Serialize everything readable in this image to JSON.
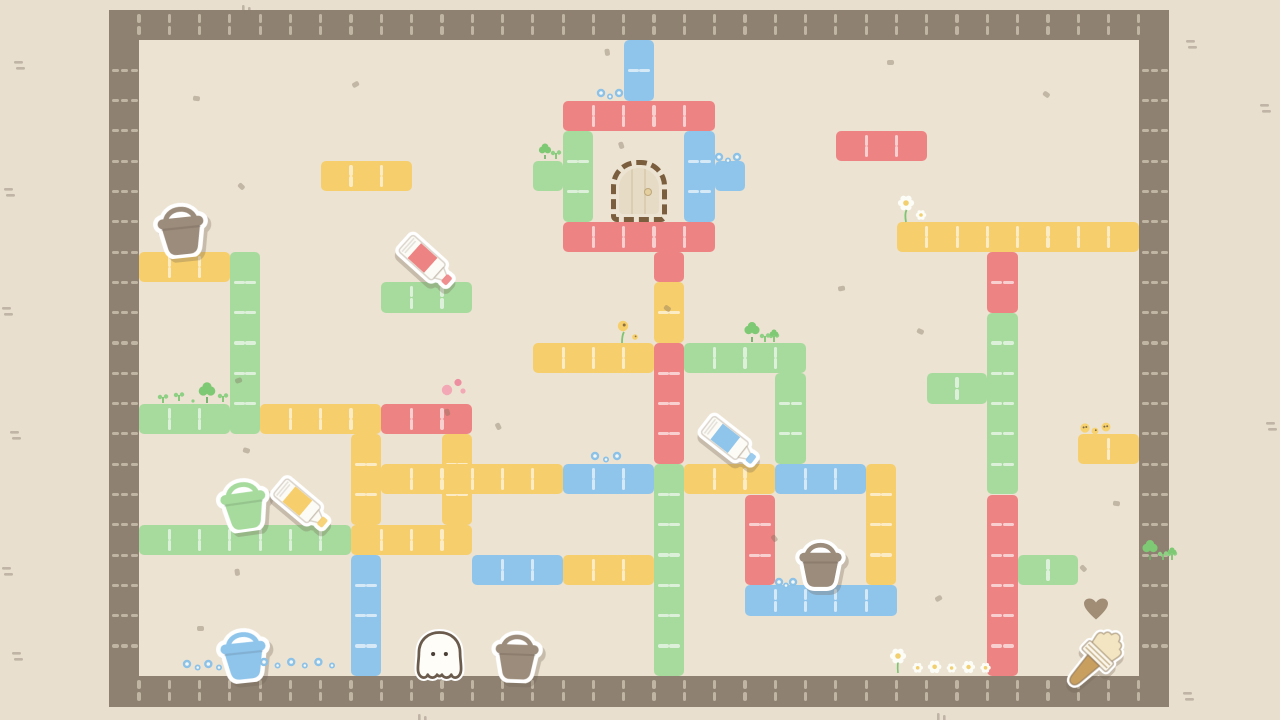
{
  "scene": {
    "width": 1280,
    "height": 720,
    "bg_outer": "#e8dfcf",
    "bg_inner": "#ece3d2",
    "wall_color": "#8e8172",
    "wall_dash": "rgba(223,213,192,0.62)",
    "block_dash": "rgba(255,255,255,0.62)",
    "shadow": "rgba(112,98,82,0.30)",
    "outline": "#6a5b4c"
  },
  "grid": {
    "origin_x": 139,
    "origin_y": 40,
    "tile": 30.3,
    "cols": 33,
    "rows": 21
  },
  "palette": {
    "red": "#ee8383",
    "yellow": "#f6ce6b",
    "green": "#a7db9e",
    "blue": "#90c5eb"
  },
  "blocks": [
    {
      "color": "blue",
      "c": 16,
      "r": 0,
      "w": 1,
      "h": 2
    },
    {
      "color": "red",
      "c": 14,
      "r": 2,
      "w": 5,
      "h": 1
    },
    {
      "color": "green",
      "c": 14,
      "r": 3,
      "w": 1,
      "h": 3
    },
    {
      "color": "green",
      "c": 13,
      "r": 4,
      "w": 1,
      "h": 1
    },
    {
      "color": "blue",
      "c": 18,
      "r": 3,
      "w": 1,
      "h": 3
    },
    {
      "color": "blue",
      "c": 19,
      "r": 4,
      "w": 1,
      "h": 1
    },
    {
      "color": "red",
      "c": 14,
      "r": 6,
      "w": 5,
      "h": 1
    },
    {
      "color": "red",
      "c": 17,
      "r": 7,
      "w": 1,
      "h": 1
    },
    {
      "color": "yellow",
      "c": 17,
      "r": 8,
      "w": 1,
      "h": 2
    },
    {
      "color": "red",
      "c": 17,
      "r": 10,
      "w": 1,
      "h": 4
    },
    {
      "color": "green",
      "c": 17,
      "r": 14,
      "w": 1,
      "h": 7
    },
    {
      "color": "yellow",
      "c": 13,
      "r": 10,
      "w": 4,
      "h": 1
    },
    {
      "color": "green",
      "c": 18,
      "r": 10,
      "w": 4,
      "h": 1
    },
    {
      "color": "green",
      "c": 21,
      "r": 11,
      "w": 1,
      "h": 3
    },
    {
      "color": "red",
      "c": 23,
      "r": 3,
      "w": 3,
      "h": 1
    },
    {
      "color": "yellow",
      "c": 25,
      "r": 6,
      "w": 8,
      "h": 1
    },
    {
      "color": "red",
      "c": 28,
      "r": 7,
      "w": 1,
      "h": 2
    },
    {
      "color": "green",
      "c": 28,
      "r": 9,
      "w": 1,
      "h": 6
    },
    {
      "color": "green",
      "c": 26,
      "r": 11,
      "w": 2,
      "h": 1
    },
    {
      "color": "red",
      "c": 28,
      "r": 15,
      "w": 1,
      "h": 6
    },
    {
      "color": "green",
      "c": 29,
      "r": 17,
      "w": 2,
      "h": 1
    },
    {
      "color": "yellow",
      "c": 31,
      "r": 13,
      "w": 2,
      "h": 1
    },
    {
      "color": "yellow",
      "c": 0,
      "r": 7,
      "w": 3,
      "h": 1
    },
    {
      "color": "green",
      "c": 3,
      "r": 7,
      "w": 1,
      "h": 6
    },
    {
      "color": "yellow",
      "c": 6,
      "r": 4,
      "w": 3,
      "h": 1
    },
    {
      "color": "green",
      "c": 0,
      "r": 12,
      "w": 3,
      "h": 1
    },
    {
      "color": "yellow",
      "c": 4,
      "r": 12,
      "w": 4,
      "h": 1
    },
    {
      "color": "red",
      "c": 8,
      "r": 12,
      "w": 3,
      "h": 1
    },
    {
      "color": "green",
      "c": 8,
      "r": 8,
      "w": 3,
      "h": 1
    },
    {
      "color": "yellow",
      "c": 7,
      "r": 13,
      "w": 1,
      "h": 3
    },
    {
      "color": "yellow",
      "c": 10,
      "r": 13,
      "w": 1,
      "h": 3
    },
    {
      "color": "green",
      "c": 0,
      "r": 16,
      "w": 7,
      "h": 1
    },
    {
      "color": "yellow",
      "c": 7,
      "r": 16,
      "w": 4,
      "h": 1
    },
    {
      "color": "blue",
      "c": 7,
      "r": 17,
      "w": 1,
      "h": 4
    },
    {
      "color": "yellow",
      "c": 8,
      "r": 14,
      "w": 6,
      "h": 1
    },
    {
      "color": "blue",
      "c": 14,
      "r": 14,
      "w": 3,
      "h": 1
    },
    {
      "color": "yellow",
      "c": 18,
      "r": 14,
      "w": 3,
      "h": 1
    },
    {
      "color": "blue",
      "c": 21,
      "r": 14,
      "w": 3,
      "h": 1
    },
    {
      "color": "yellow",
      "c": 24,
      "r": 14,
      "w": 1,
      "h": 4
    },
    {
      "color": "red",
      "c": 20,
      "r": 15,
      "w": 1,
      "h": 3
    },
    {
      "color": "blue",
      "c": 20,
      "r": 18,
      "w": 5,
      "h": 1
    },
    {
      "color": "blue",
      "c": 11,
      "r": 17,
      "w": 3,
      "h": 1
    },
    {
      "color": "yellow",
      "c": 14,
      "r": 17,
      "w": 3,
      "h": 1
    }
  ],
  "items": [
    {
      "type": "bucket",
      "name": "brown-bucket-1",
      "color": "#9c8c7b",
      "x": 150,
      "y": 197,
      "w": 62,
      "h": 61,
      "rot": -6
    },
    {
      "type": "tube",
      "name": "red-paint-tube",
      "label": "#ee8383",
      "x": 393,
      "y": 247,
      "w": 68,
      "h": 30,
      "rot": 42
    },
    {
      "type": "door",
      "name": "door",
      "x": 611,
      "y": 160,
      "w": 56,
      "h": 62,
      "rot": 0
    },
    {
      "type": "tube",
      "name": "blue-paint-tube",
      "label": "#90c5eb",
      "x": 696,
      "y": 427,
      "w": 68,
      "h": 30,
      "rot": 38
    },
    {
      "type": "bucket",
      "name": "green-bucket",
      "color": "#a7db9e",
      "x": 213,
      "y": 473,
      "w": 61,
      "h": 59,
      "rot": -8
    },
    {
      "type": "tube",
      "name": "yellow-paint-tube",
      "label": "#f6ce6b",
      "x": 268,
      "y": 490,
      "w": 68,
      "h": 30,
      "rot": 40
    },
    {
      "type": "bucket",
      "name": "brown-bucket-2",
      "color": "#9c8c7b",
      "x": 792,
      "y": 533,
      "w": 57,
      "h": 58,
      "rot": 0
    },
    {
      "type": "bucket",
      "name": "blue-bucket",
      "color": "#90c5eb",
      "x": 213,
      "y": 622,
      "w": 61,
      "h": 61,
      "rot": -6
    },
    {
      "type": "octopus",
      "name": "octopus-character",
      "x": 414,
      "y": 628,
      "w": 51,
      "h": 55,
      "rot": 0
    },
    {
      "type": "bucket",
      "name": "brown-bucket-3",
      "color": "#9c8c7b",
      "x": 488,
      "y": 625,
      "w": 58,
      "h": 58,
      "rot": 2
    },
    {
      "type": "heart",
      "name": "heart-mark",
      "x": 1083,
      "y": 597,
      "w": 26,
      "h": 25,
      "rot": 0
    },
    {
      "type": "brush",
      "name": "paintbrush",
      "x": 1072,
      "y": 622,
      "w": 46,
      "h": 74,
      "rot": 44
    }
  ],
  "decorations": [
    {
      "type": "flowers_blue",
      "x": 595,
      "y": 84,
      "n": 3,
      "w": 30
    },
    {
      "type": "flowers_blue",
      "x": 713,
      "y": 148,
      "n": 3,
      "w": 30
    },
    {
      "type": "flowers_blue",
      "x": 589,
      "y": 447,
      "n": 3,
      "w": 34
    },
    {
      "type": "flowers_blue",
      "x": 773,
      "y": 573,
      "n": 3,
      "w": 26
    },
    {
      "type": "flowers_blue",
      "x": 181,
      "y": 655,
      "n": 4,
      "w": 44
    },
    {
      "type": "flowers_blue",
      "x": 258,
      "y": 653,
      "n": 6,
      "w": 80
    },
    {
      "type": "flower_white",
      "x": 894,
      "y": 193
    },
    {
      "type": "flowers_white_row",
      "x": 888,
      "y": 645,
      "w": 106
    },
    {
      "type": "flower_yellow",
      "x": 612,
      "y": 317
    },
    {
      "type": "dots_yellow",
      "x": 1078,
      "y": 420
    },
    {
      "type": "clover",
      "x": 531,
      "y": 142
    },
    {
      "type": "clover_group",
      "x": 741,
      "y": 316
    },
    {
      "type": "clover_group",
      "x": 1139,
      "y": 534
    },
    {
      "type": "plants_row",
      "x": 155,
      "y": 381
    },
    {
      "type": "dots_pink",
      "x": 437,
      "y": 377
    }
  ],
  "speckles": [
    [
      352,
      82
    ],
    [
      193,
      96
    ],
    [
      238,
      184
    ],
    [
      604,
      50
    ],
    [
      887,
      60
    ],
    [
      1043,
      92
    ],
    [
      618,
      143
    ],
    [
      838,
      286
    ],
    [
      917,
      329
    ],
    [
      495,
      424
    ],
    [
      235,
      378
    ],
    [
      243,
      448
    ],
    [
      771,
      536
    ],
    [
      935,
      596
    ],
    [
      1113,
      501
    ],
    [
      1080,
      566
    ],
    [
      234,
      570
    ],
    [
      197,
      626
    ],
    [
      664,
      306
    ],
    [
      444,
      410
    ]
  ],
  "outer_marks": [
    {
      "x": 14,
      "y": 57,
      "o": "h"
    },
    {
      "x": 4,
      "y": 184,
      "o": "h"
    },
    {
      "x": 2,
      "y": 303,
      "o": "h"
    },
    {
      "x": 10,
      "y": 427,
      "o": "h"
    },
    {
      "x": 2,
      "y": 563,
      "o": "h"
    },
    {
      "x": 12,
      "y": 648,
      "o": "h"
    },
    {
      "x": 1186,
      "y": 36,
      "o": "h"
    },
    {
      "x": 1260,
      "y": 100,
      "o": "h"
    },
    {
      "x": 1266,
      "y": 418,
      "o": "h"
    },
    {
      "x": 1183,
      "y": 688,
      "o": "h"
    },
    {
      "x": 936,
      "y": 710,
      "o": "v"
    },
    {
      "x": 417,
      "y": 711,
      "o": "v"
    },
    {
      "x": 241,
      "y": 2,
      "o": "v"
    }
  ]
}
